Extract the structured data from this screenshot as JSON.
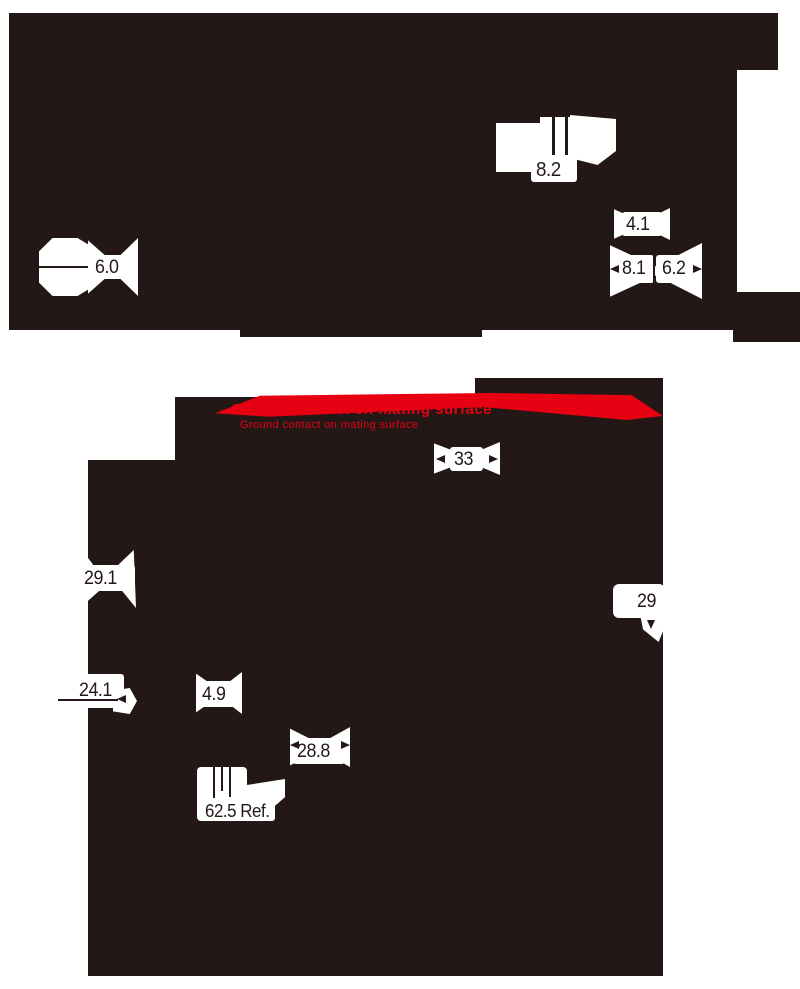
{
  "colors": {
    "ink": "#231815",
    "red": "#e60012",
    "paper": "#ffffff"
  },
  "annotation": {
    "line1": "Ground contact on mating surface",
    "line2": "Ground contact on mating surface"
  },
  "dimensions": {
    "hex_across_flats": "6.0",
    "slot_width": "8.2",
    "pin_offset": "4.1",
    "rear_diameter": "8.1",
    "boot_diameter": "6.2",
    "panel_height": "33",
    "front_height": "29.1",
    "front_width": "29",
    "side_depth": "24.1",
    "flange_thickness": "4.9",
    "body_width": "28.8",
    "overall_length": "62.5 Ref."
  }
}
